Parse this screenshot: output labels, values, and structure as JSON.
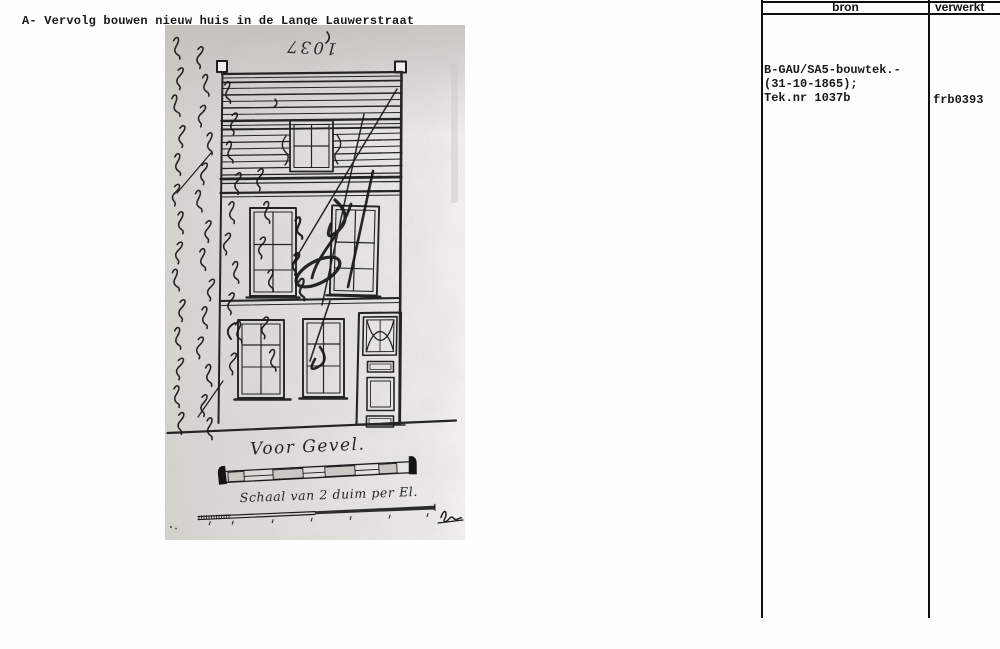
{
  "header": {
    "title": "A- Vervolg bouwen nieuw huis in de Lange Lauwerstraat"
  },
  "table": {
    "columns": [
      {
        "label": "bron"
      },
      {
        "label": "verwerkt"
      }
    ],
    "record": {
      "bron_lines": [
        "B-GAU/SA5-bouwtek.-",
        "(31-10-1865);",
        "Tek.nr 1037b"
      ],
      "verwerkt": "frb0393"
    }
  },
  "drawing": {
    "plan_number": "1037",
    "caption_facade": "Voor Gevel.",
    "caption_scale": "Schaal van 2 duim per El."
  },
  "colors": {
    "ink": "#1d1d1d",
    "scan_background": "#e6e4e1",
    "page_background": "#ffffff"
  }
}
